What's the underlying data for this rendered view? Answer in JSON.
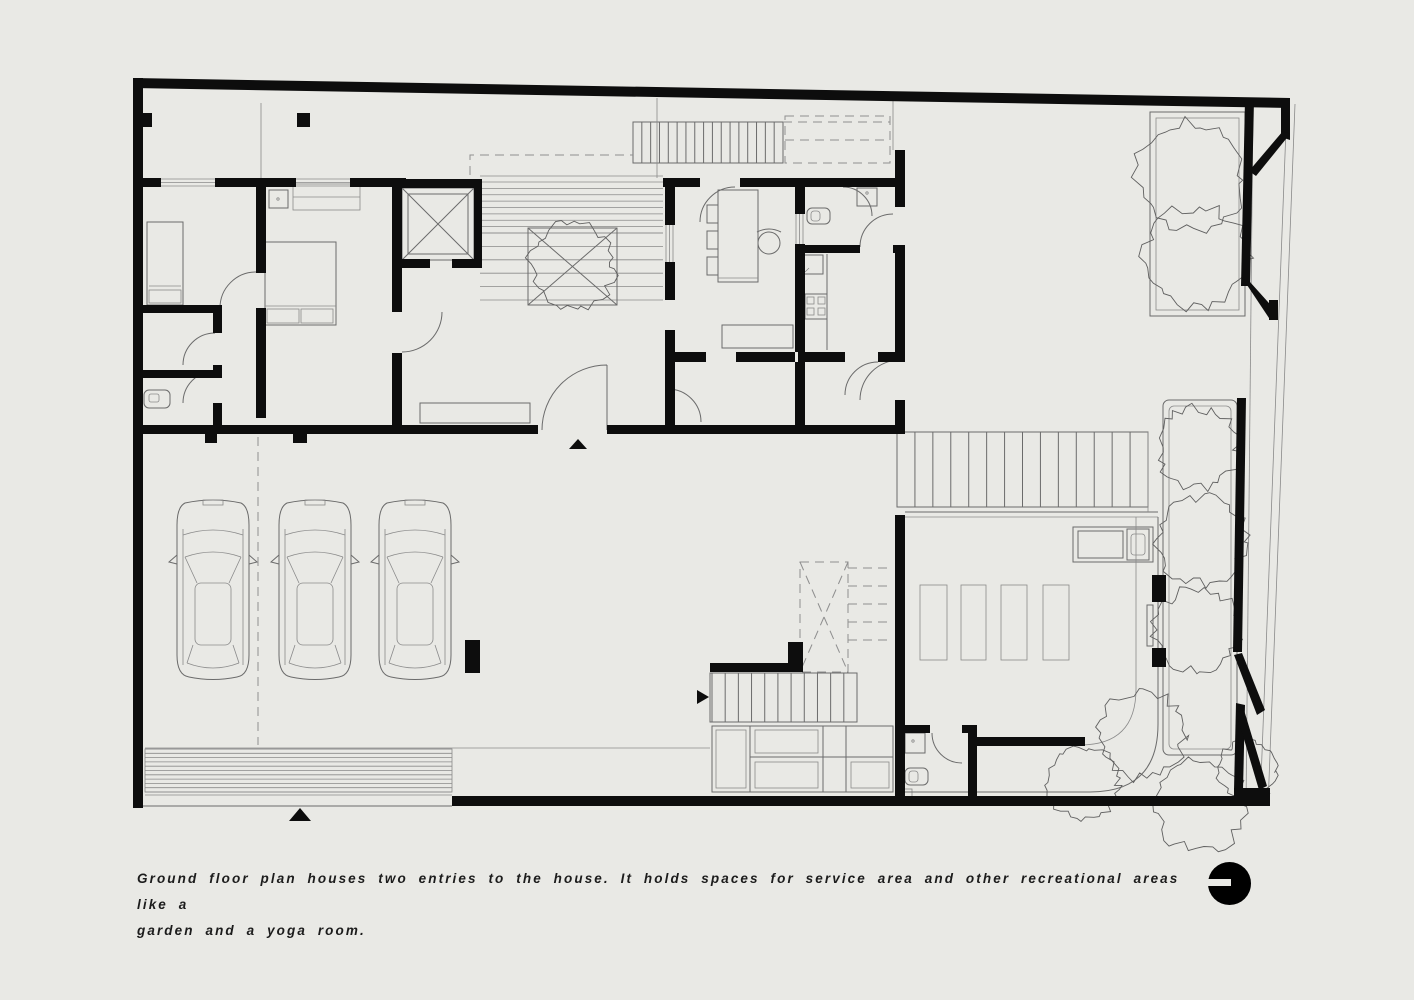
{
  "canvas": {
    "width": 1414,
    "height": 1000,
    "background": "#e9e9e5",
    "wall_color": "#0d0d0d",
    "line_color": "#6b6b6b",
    "dash_color": "#8f8f8f"
  },
  "caption": {
    "line1": "Ground floor plan houses two entries to the house. It holds spaces for service area and other recreational areas like a",
    "line2": "garden and a yoga room."
  },
  "logo": {
    "name": "studio-logo-circle",
    "color": "#000000"
  },
  "plan": {
    "type": "ground-floor-plan",
    "entries": 2,
    "garage_cars": 3,
    "yoga_mats": 4,
    "bedrooms": 2,
    "areas": [
      "garage",
      "entry deck",
      "courtyard tree",
      "living room",
      "dining room",
      "kitchen",
      "bedrooms",
      "bathrooms",
      "service area",
      "stair hall",
      "yoga room",
      "garden"
    ]
  }
}
